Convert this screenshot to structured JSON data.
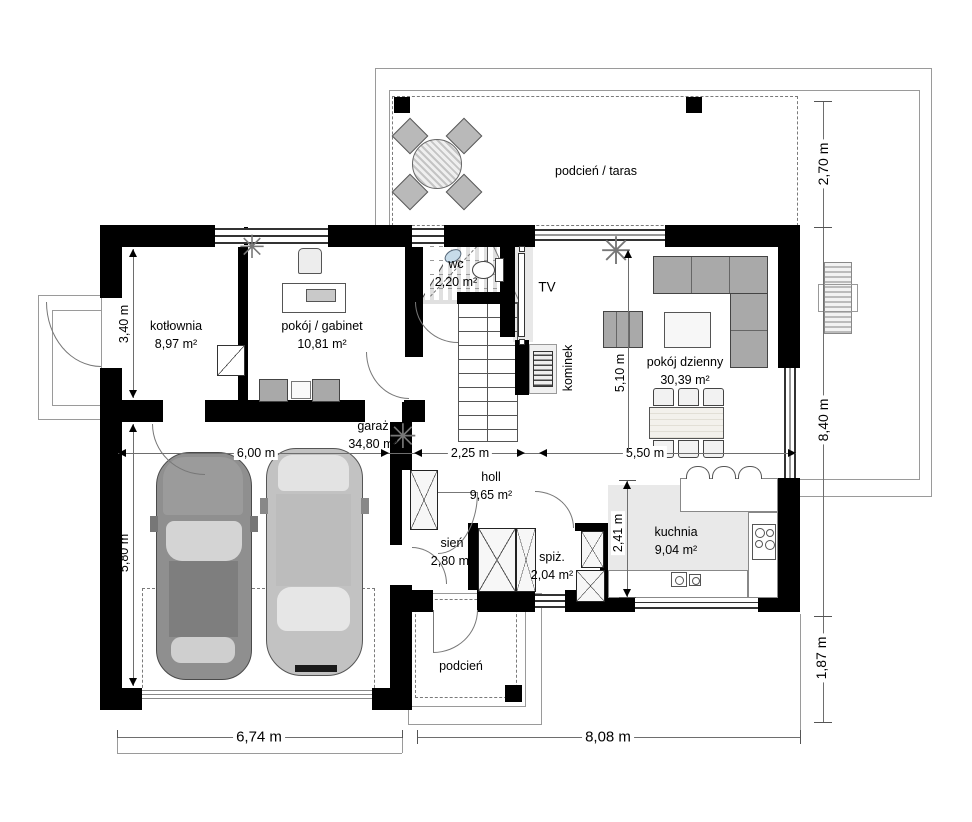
{
  "plan": {
    "rooms": [
      {
        "id": "kotlownia",
        "name": "kotłownia",
        "area": "8,97 m²"
      },
      {
        "id": "gabinet",
        "name": "pokój / gabinet",
        "area": "10,81 m²"
      },
      {
        "id": "wc",
        "name": "wc",
        "area": "2,20 m²"
      },
      {
        "id": "dzienny",
        "name": "pokój dzienny",
        "area": "30,39 m²"
      },
      {
        "id": "garaz",
        "name": "garaż",
        "area": "34,80 m²"
      },
      {
        "id": "holl",
        "name": "holl",
        "area": "9,65 m²"
      },
      {
        "id": "sien",
        "name": "sień",
        "area": "2,80 m²"
      },
      {
        "id": "spiz",
        "name": "spiż.",
        "area": "2,04 m²"
      },
      {
        "id": "kuchnia",
        "name": "kuchnia",
        "area": "9,04 m²"
      }
    ],
    "outdoor_labels": {
      "taras": "podcień / taras",
      "podcien": "podcień"
    },
    "fixture_labels": {
      "tv": "TV",
      "kominek": "kominek"
    },
    "dimensions": {
      "left_upper": "3,40 m",
      "left_lower": "5,80 m",
      "garage_width": "6,00 m",
      "hall_width": "2,25 m",
      "living_width": "5,50 m",
      "living_depth": "5,10 m",
      "kitchen_depth": "2,41 m",
      "terrace_depth": "2,70 m",
      "right_height": "8,40 m",
      "right_lower": "1,87 m",
      "bottom_left": "6,74 m",
      "bottom_right": "8,08 m"
    },
    "plant_glyph": "✳"
  }
}
